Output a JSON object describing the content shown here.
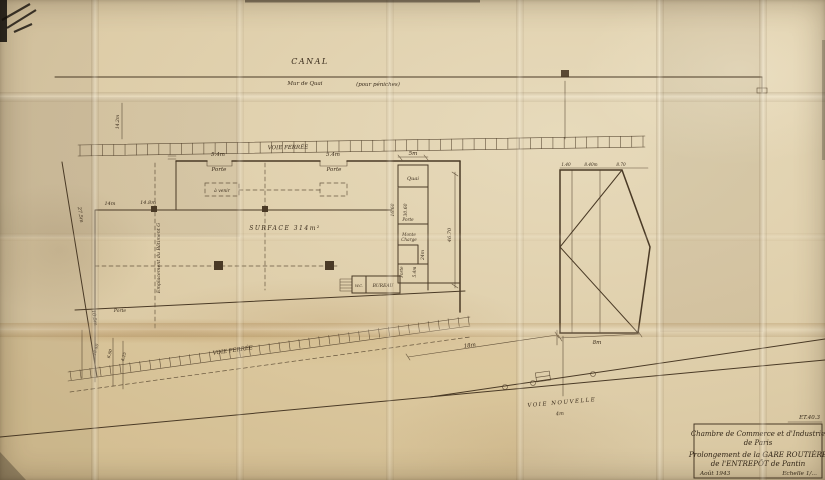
{
  "document": {
    "reference": "ET.40.3",
    "title_block": {
      "org_line1": "Chambre de Commerce et d'Industrie",
      "org_line2": "de Paris",
      "project_line1": "Prolongement de la GARE ROUTIÈRE",
      "project_line2": "de l'ENTREPÔT de Pantin",
      "date": "Août 1943",
      "scale": "Echelle 1/..."
    }
  },
  "plan": {
    "canal": {
      "label": "CANAL",
      "wall_label": "Mur de Quai",
      "wall_note": "(pour péniches)"
    },
    "rail_top_label": "VOIE FERRÉE",
    "rail_bottom_label": "VOIE FERRÉE",
    "voie_nouvelle_label": "VOIE NOUVELLE",
    "surface_label": "SURFACE 314m²",
    "quai_box_label": "Quai",
    "bureau_label": "BUREAU",
    "wc_label": "W.C.",
    "a_venir_label": "à venir",
    "emplacement_label": "Emplacement du Bâtiment G",
    "annotations": [
      {
        "x": 218,
        "y": 156,
        "t": "5.4m"
      },
      {
        "x": 219,
        "y": 171,
        "t": "Porte"
      },
      {
        "x": 333,
        "y": 156,
        "t": "5.4m"
      },
      {
        "x": 334,
        "y": 171,
        "t": "Porte"
      },
      {
        "x": 413,
        "y": 155,
        "t": "5m"
      },
      {
        "x": 110,
        "y": 205,
        "t": "14m",
        "fs": 5
      },
      {
        "x": 148,
        "y": 204,
        "t": "14.8m",
        "fs": 5
      },
      {
        "x": 79,
        "y": 215,
        "t": "27.5m",
        "rot": 81,
        "fs": 5
      },
      {
        "x": 93,
        "y": 318,
        "t": "10.5m",
        "rot": 81,
        "fs": 5
      },
      {
        "x": 394,
        "y": 210,
        "t": "16.60",
        "rot": -90,
        "fs": 4.5
      },
      {
        "x": 407,
        "y": 210,
        "t": "30.60",
        "rot": -90,
        "fs": 4.5
      },
      {
        "x": 451,
        "y": 235,
        "t": "46.70",
        "rot": -90,
        "fs": 5
      },
      {
        "x": 408,
        "y": 221,
        "t": "Porte",
        "fs": 4.2
      },
      {
        "x": 409,
        "y": 236,
        "t": "Monte",
        "fs": 4.2
      },
      {
        "x": 409,
        "y": 241,
        "t": "Charge",
        "fs": 4.2
      },
      {
        "x": 424,
        "y": 255,
        "t": "24m",
        "rot": -90,
        "fs": 4.5
      },
      {
        "x": 416,
        "y": 272,
        "t": "5.4m",
        "rot": -90,
        "fs": 4.2
      },
      {
        "x": 403,
        "y": 272,
        "t": "Porte",
        "rot": -90,
        "fs": 4.2
      },
      {
        "x": 470,
        "y": 347,
        "t": "18m",
        "rot": -8,
        "fs": 5.5
      },
      {
        "x": 597,
        "y": 344,
        "t": "8m",
        "fs": 5.5
      },
      {
        "x": 560,
        "y": 415,
        "t": "4m",
        "rot": -5,
        "fs": 5
      },
      {
        "x": 566,
        "y": 166,
        "t": "1.40",
        "fs": 4.2
      },
      {
        "x": 591,
        "y": 166,
        "t": "8.40m",
        "fs": 4.2
      },
      {
        "x": 621,
        "y": 166,
        "t": "8.70",
        "fs": 4.2
      },
      {
        "x": 97,
        "y": 350,
        "t": "10.40",
        "rot": -75,
        "fs": 4.2
      },
      {
        "x": 111,
        "y": 354,
        "t": "6.80",
        "rot": -75,
        "fs": 4.2
      },
      {
        "x": 125,
        "y": 357,
        "t": "4.25",
        "rot": -75,
        "fs": 4.2
      },
      {
        "x": 119,
        "y": 122,
        "t": "14.2m",
        "rot": -90,
        "fs": 4.5
      },
      {
        "x": 120,
        "y": 312,
        "t": "Porte",
        "fs": 4.5
      }
    ]
  }
}
